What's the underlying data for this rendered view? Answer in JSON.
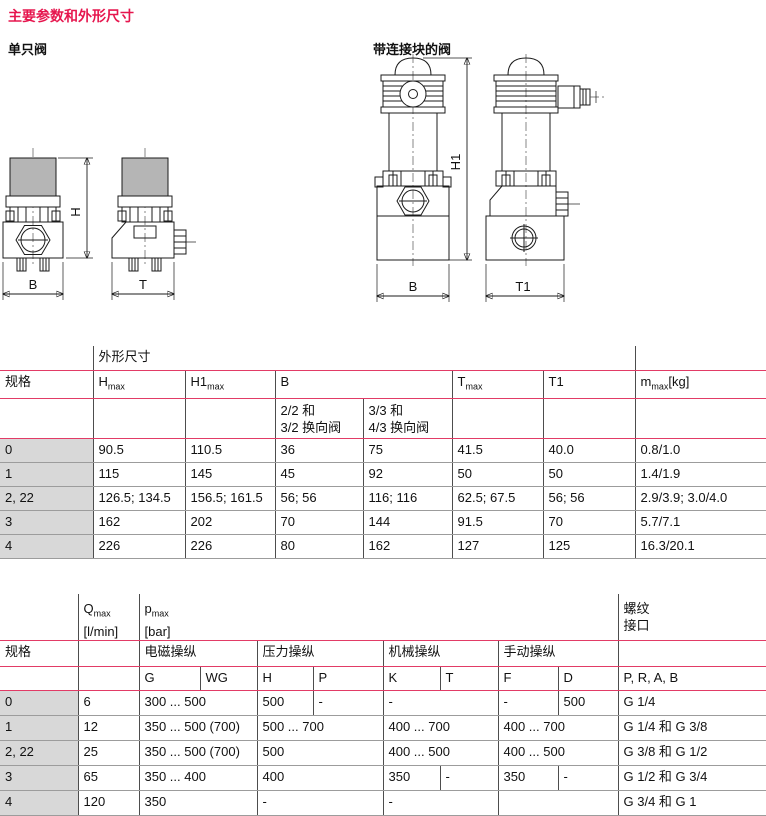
{
  "colors": {
    "heading_red": "#e6164e",
    "table_line_red": "#e23b66",
    "spec_cell_bg": "#d8d8d8"
  },
  "page": {
    "heading": "主要参数和外形尺寸"
  },
  "figures": {
    "single_valve": {
      "label": "单只阀",
      "dim_h": "H",
      "dim_b": "B",
      "dim_t": "T"
    },
    "block_valve": {
      "label": "带连接块的阀",
      "dim_h1": "H1",
      "dim_b": "B",
      "dim_t1": "T1"
    }
  },
  "table1": {
    "group_header": "外形尺寸",
    "spec_label": "规格",
    "headers": {
      "hmax": {
        "base": "H",
        "sub": "max"
      },
      "h1max": {
        "base": "H1",
        "sub": "max"
      },
      "b": "B",
      "tmax": {
        "base": "T",
        "sub": "max"
      },
      "t1": "T1",
      "m": {
        "base": "m",
        "sub": "max",
        "suffix": "[kg]"
      }
    },
    "b_subcols": [
      [
        "2/2 和",
        "3/2 换向阀"
      ],
      [
        "3/3 和",
        "4/3 换向阀"
      ]
    ],
    "rows": [
      [
        "0",
        "90.5",
        "110.5",
        "36",
        "75",
        "41.5",
        "40.0",
        "0.8/1.0"
      ],
      [
        "1",
        "115",
        "145",
        "45",
        "92",
        "50",
        "50",
        "1.4/1.9"
      ],
      [
        "2, 22",
        "126.5; 134.5",
        "156.5; 161.5",
        "56; 56",
        "116; 116",
        "62.5; 67.5",
        "56; 56",
        "2.9/3.9; 3.0/4.0"
      ],
      [
        "3",
        "162",
        "202",
        "70",
        "144",
        "91.5",
        "70",
        "5.7/7.1"
      ],
      [
        "4",
        "226",
        "226",
        "80",
        "162",
        "127",
        "125",
        "16.3/20.1"
      ]
    ]
  },
  "table2": {
    "spec_label": "规格",
    "headers": {
      "qmax": {
        "base": "Q",
        "sub": "max",
        "unit": "[l/min]"
      },
      "pmax": {
        "base": "p",
        "sub": "max",
        "unit": "[bar]"
      },
      "thread": [
        "螺纹",
        "接口"
      ]
    },
    "groups": [
      "电磁操纵",
      "压力操纵",
      "机械操纵",
      "手动操纵"
    ],
    "subcols": [
      "G",
      "WG",
      "H",
      "P",
      "K",
      "T",
      "F",
      "D"
    ],
    "ports": "P, R, A, B",
    "rows": [
      [
        "0",
        "6",
        "300 ... 500",
        "500",
        "-",
        "-",
        "-",
        "500",
        "G 1/4"
      ],
      [
        "1",
        "12",
        "350 ... 500 (700)",
        "500 ... 700",
        "400 ... 700",
        "400 ... 700",
        "G 1/4 和 G 3/8"
      ],
      [
        "2, 22",
        "25",
        "350 ... 500 (700)",
        "500",
        "400 ... 500",
        "400 ... 500",
        "G 3/8 和 G 1/2"
      ],
      [
        "3",
        "65",
        "350 ... 400",
        "400",
        "350",
        "-",
        "350",
        "-",
        "G 1/2 和 G 3/4"
      ],
      [
        "4",
        "120",
        "350",
        "-",
        "-",
        "",
        "G 3/4 和 G 1"
      ]
    ]
  }
}
